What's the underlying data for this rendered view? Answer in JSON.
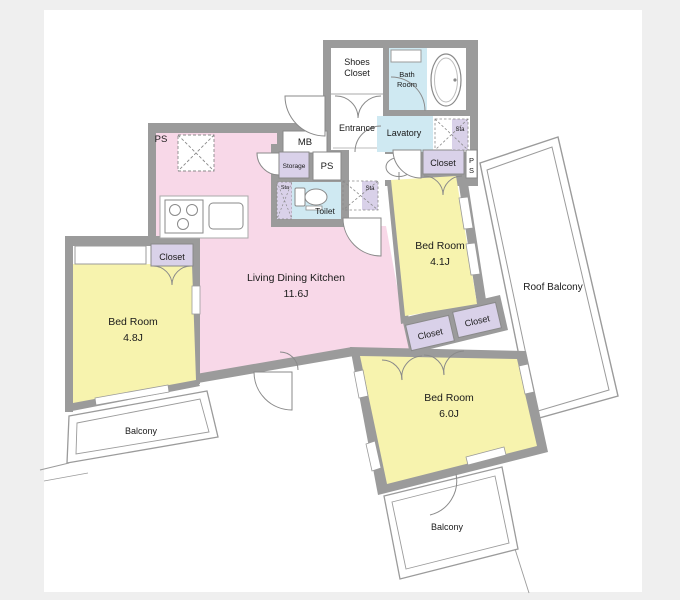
{
  "floorplan": {
    "colors": {
      "background": "#efefef",
      "canvas": "#ffffff",
      "wall": "#9b9b9b",
      "ldk_pink": "#f8d8e8",
      "bedroom_yellow": "#f7f3ae",
      "wet_blue": "#cfe9f2",
      "closet_purple": "#d9d1e9",
      "line": "#8a8a8a"
    },
    "rooms": {
      "ldk": {
        "name": "Living Dining Kitchen",
        "size": "11.6J"
      },
      "bedroom_left": {
        "name": "Bed Room",
        "size": "4.8J"
      },
      "bedroom_right": {
        "name": "Bed Room",
        "size": "4.1J"
      },
      "bedroom_bottom": {
        "name": "Bed Room",
        "size": "6.0J"
      }
    },
    "labels": {
      "shoes_line1": "Shoes",
      "shoes_line2": "Closet",
      "entrance": "Entrance",
      "bath_line1": "Bath",
      "bath_line2": "Room",
      "lavatory": "Lavatory",
      "mb": "MB",
      "ps": "PS",
      "p": "P",
      "s": "S",
      "storage": "Storage",
      "sta": "Sta",
      "toilet": "Toilet",
      "closet": "Closet",
      "ldk_name": "Living Dining Kitchen",
      "ldk_size": "11.6J",
      "bedroom_name": "Bed Room",
      "bed41_size": "4.1J",
      "bed48_size": "4.8J",
      "bed60_size": "6.0J",
      "roof_balcony": "Roof Balcony",
      "balcony": "Balcony"
    }
  }
}
